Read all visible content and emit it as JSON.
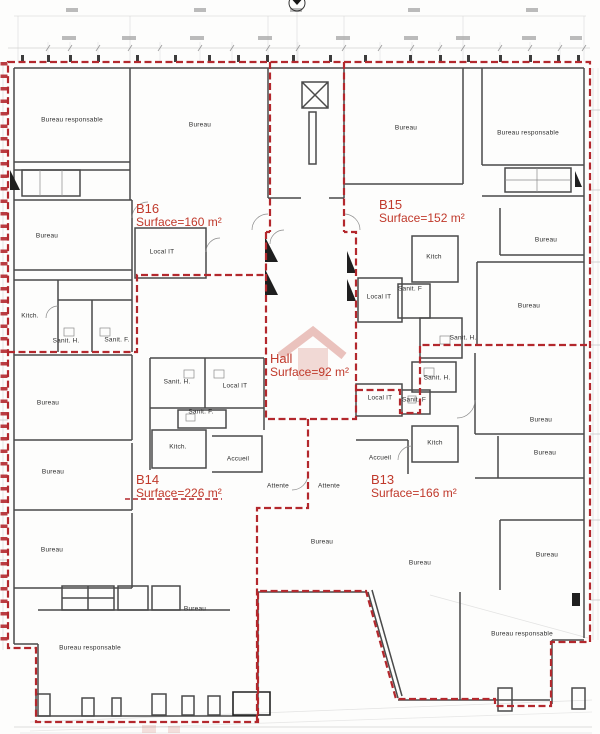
{
  "drawing": {
    "kind": "architectural-floor-plan",
    "zones": [
      {
        "id": "B16",
        "surface": "Surface=160 m²",
        "x": 136,
        "y": 202
      },
      {
        "id": "B15",
        "surface": "Surface=152 m²",
        "x": 379,
        "y": 198
      },
      {
        "id": "Hall",
        "surface": "Surface=92 m²",
        "x": 270,
        "y": 352
      },
      {
        "id": "B14",
        "surface": "Surface=226 m²",
        "x": 136,
        "y": 473
      },
      {
        "id": "B13",
        "surface": "Surface=166 m²",
        "x": 371,
        "y": 473
      }
    ],
    "rooms": [
      {
        "label": "Bureau responsable",
        "x": 72,
        "y": 120
      },
      {
        "label": "Bureau",
        "x": 200,
        "y": 125
      },
      {
        "label": "Bureau",
        "x": 406,
        "y": 128
      },
      {
        "label": "Bureau responsable",
        "x": 528,
        "y": 133
      },
      {
        "label": "Bureau",
        "x": 47,
        "y": 236
      },
      {
        "label": "Local IT",
        "x": 162,
        "y": 252
      },
      {
        "label": "Kitch.",
        "x": 30,
        "y": 316
      },
      {
        "label": "Sanit. H.",
        "x": 66,
        "y": 341
      },
      {
        "label": "Sanit. F.",
        "x": 117,
        "y": 340
      },
      {
        "label": "Kitch",
        "x": 434,
        "y": 257
      },
      {
        "label": "Sanit. F",
        "x": 410,
        "y": 289
      },
      {
        "label": "Local IT",
        "x": 379,
        "y": 297
      },
      {
        "label": "Bureau",
        "x": 546,
        "y": 240
      },
      {
        "label": "Bureau",
        "x": 529,
        "y": 306
      },
      {
        "label": "Sanit. H.",
        "x": 463,
        "y": 338
      },
      {
        "label": "Bureau",
        "x": 48,
        "y": 403
      },
      {
        "label": "Sanit. H.",
        "x": 177,
        "y": 382
      },
      {
        "label": "Local IT",
        "x": 235,
        "y": 386
      },
      {
        "label": "Sanit. F.",
        "x": 201,
        "y": 412
      },
      {
        "label": "Kitch.",
        "x": 178,
        "y": 447
      },
      {
        "label": "Accueil",
        "x": 238,
        "y": 459
      },
      {
        "label": "Sanit. H.",
        "x": 437,
        "y": 378
      },
      {
        "label": "Local IT",
        "x": 380,
        "y": 398
      },
      {
        "label": "Sanit. F",
        "x": 414,
        "y": 400
      },
      {
        "label": "Kitch",
        "x": 435,
        "y": 443
      },
      {
        "label": "Accueil",
        "x": 380,
        "y": 458
      },
      {
        "label": "Attente",
        "x": 278,
        "y": 486
      },
      {
        "label": "Attente",
        "x": 329,
        "y": 486
      },
      {
        "label": "Bureau",
        "x": 53,
        "y": 472
      },
      {
        "label": "Bureau",
        "x": 52,
        "y": 550
      },
      {
        "label": "Bureau",
        "x": 322,
        "y": 542
      },
      {
        "label": "Bureau",
        "x": 420,
        "y": 563
      },
      {
        "label": "Bureau",
        "x": 547,
        "y": 555
      },
      {
        "label": "Bureau",
        "x": 541,
        "y": 420
      },
      {
        "label": "Bureau",
        "x": 545,
        "y": 453
      },
      {
        "label": "Bureau",
        "x": 195,
        "y": 609
      },
      {
        "label": "Bureau responsable",
        "x": 90,
        "y": 648
      },
      {
        "label": "Bureau responsable",
        "x": 522,
        "y": 634
      }
    ],
    "colors": {
      "zone_boundary": "#b3282d",
      "zone_label": "#c0392b",
      "walls": "#4a4a4a",
      "dimension_lines": "#c9c9c9"
    }
  }
}
